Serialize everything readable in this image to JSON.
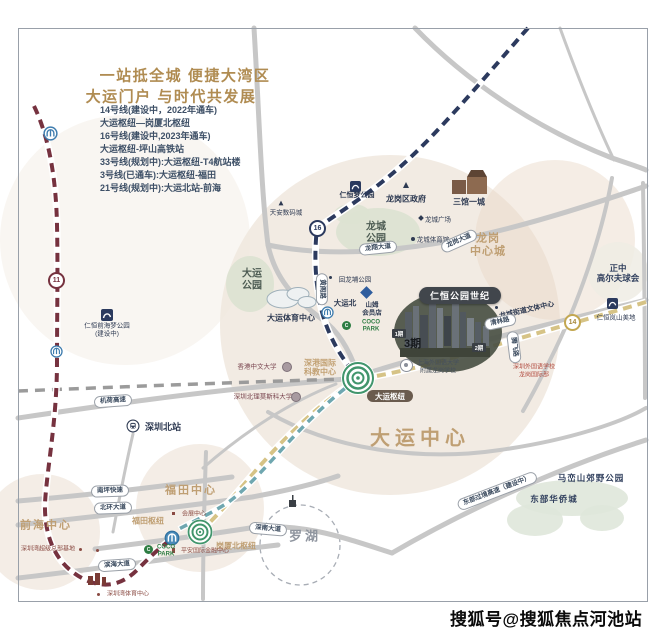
{
  "legend": {
    "title_line1": "一站抵全城 便捷大湾区",
    "title_line2": "大运门户 与时代共发展",
    "lines": [
      "14号线(建设中，2022年通车)",
      "大运枢纽—岗厦北枢纽",
      "16号线(建设中,2023年通车)",
      "大运枢纽-坪山高铁站",
      "33号线(规划中):大运枢纽-T4航站楼",
      "3号线(已通车):大运枢纽-福田",
      "21号线(规划中):大运北站-前海"
    ]
  },
  "areas": {
    "dayun_center": "大运中心",
    "futian_center": "福田中心",
    "qianhai_center": "前海中心",
    "luohu": "罗湖",
    "longgang_line1": "龙岗",
    "longgang_line2": "中心城",
    "skic_line1": "深港国际",
    "skic_line2": "科教中心"
  },
  "parks": {
    "longcheng_line1": "龙城",
    "longcheng_line2": "公园",
    "dayun_line1": "大运",
    "dayun_line2": "公园",
    "maluanshan": "马峦山郊野公园",
    "oct_east": "东部华侨城",
    "huilongpu": "回龙埔公园"
  },
  "hubs": {
    "dayun": "大运枢纽",
    "gangxiabei": "岗厦北枢纽",
    "futian": "福田枢纽"
  },
  "stations": {
    "shenzhen_north": "深圳北站",
    "dayun_north": "大运北"
  },
  "badges": {
    "line11": "11",
    "line14": "14",
    "line16": "16"
  },
  "project": {
    "name": "仁恒公园世纪",
    "phase1": "1期",
    "phase2": "2期",
    "phase3": "3期",
    "school_line1": "上海外国语大学",
    "school_line2": "附属龙岗学校",
    "intl_school_line1": "深圳外国语学校",
    "intl_school_line2": "龙岗国际部"
  },
  "pois": {
    "renheng_dream_park": "仁恒梦公园",
    "longgang_gov": "龙岗区政府",
    "three_halls": "三馆一城",
    "tianan": "天安数码城",
    "longcheng_square": "龙城广场",
    "longcheng_gym": "龙城体育馆",
    "sam_line1": "山姆",
    "sam_line2": "会员店",
    "dayun_stadium": "大运体育中心",
    "coco_line1": "COCO",
    "coco_line2": "PARK",
    "wenti_center": "龙城街道文体中心",
    "zhengzhong_line1": "正中",
    "zhengzhong_line2": "高尔夫球会",
    "lanshan": "仁恒岚山美地",
    "cuhk": "香港中文大学",
    "msu_bit": "深圳北理莫斯科大学",
    "exhibition": "会展中心",
    "pingan": "平安国际金融中心",
    "szbay_hq": "深圳湾超级总部基地",
    "szbay_sports": "深圳湾体育中心",
    "qianhai_dream": "仁恒前海梦公园",
    "qianhai_dream_status": "(建设中)"
  },
  "roads": {
    "longxiang": "龙翔大道",
    "longgang_ave": "龙岗大道",
    "qinglin": "清林路",
    "huangge": "黄阁路",
    "tengfei": "腾飞路",
    "dongbu": "东部过境高速（建设中）",
    "jihe": "机荷高速",
    "nanping": "南坪快速",
    "beihuan": "北环大道",
    "shennan": "深南大道",
    "binhai": "滨海大道"
  },
  "watermark": "搜狐号@搜狐焦点河池站",
  "colors": {
    "line11": "#76323f",
    "line16": "#2c3a5e",
    "line14": "#d6c386",
    "line3": "#6fa7b0",
    "line21": "#9b9b9b",
    "hub_green": "#41956c",
    "accent_tan": "#bf9f73"
  }
}
